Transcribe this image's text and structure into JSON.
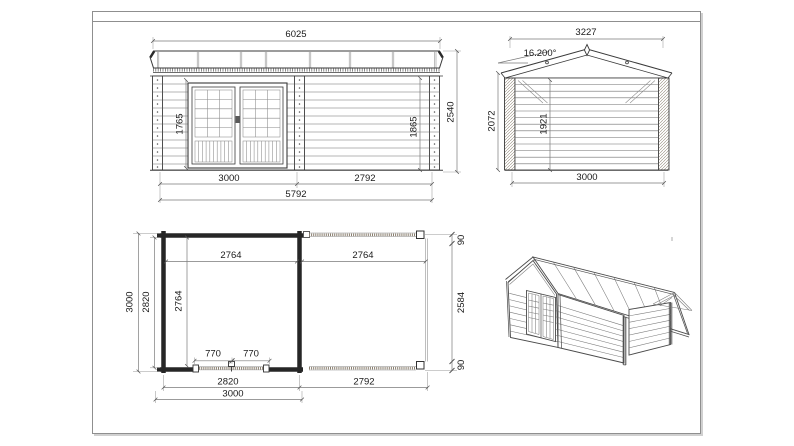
{
  "colors": {
    "line": "#3a3a3a",
    "dimension": "#7a7a7a",
    "beam_hatch": "#8a7f6f"
  },
  "views": {
    "front": {
      "dims": {
        "overall_width": "6025",
        "overall_height": "2540",
        "door_height": "1765",
        "opening_height": "1865",
        "cabin_width": "3000",
        "canopy_width": "2792",
        "total_width": "5792"
      }
    },
    "side": {
      "dims": {
        "roof_width": "3227",
        "roof_angle": "16.200°",
        "eave_height": "2072",
        "interior_height": "1921",
        "depth": "3000"
      }
    },
    "plan": {
      "dims": {
        "cabin_inner_width": "2764",
        "canopy_inner_width": "2764",
        "depth_overall": "3000",
        "depth_wall": "2820",
        "cabin_inner_depth": "2764",
        "door_left": "770",
        "door_right": "770",
        "post_top": "90",
        "canopy_depth": "2584",
        "post_bottom": "90",
        "cabin_width": "2820",
        "canopy_width": "2792",
        "cabin_total_width": "3000"
      }
    }
  }
}
